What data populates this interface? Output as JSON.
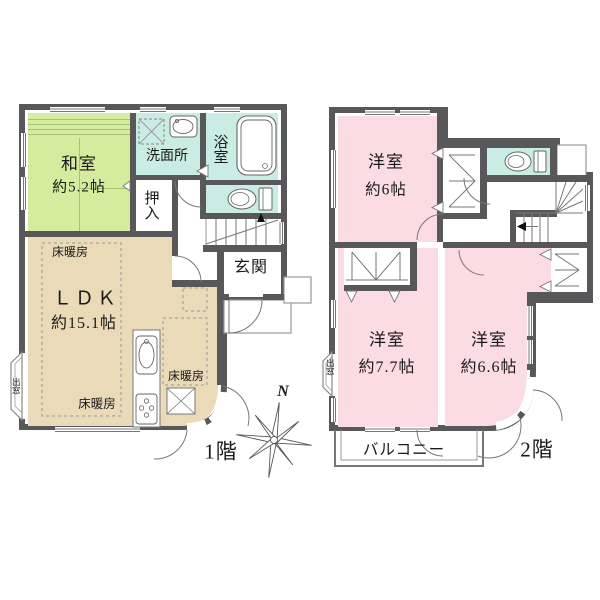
{
  "title": "2階建て間取り図",
  "floor1": {
    "floor_label": "1階",
    "washitsu_name": "和室",
    "washitsu_size": "約5.2帖",
    "senmenjo": "洗面所",
    "yokushitsu": "浴室",
    "oshiire": "押入",
    "genkan": "玄関",
    "ldk_name": "ＬＤＫ",
    "ldk_size": "約15.1帖",
    "yukadanbo": "床暖房",
    "demado": "出窓"
  },
  "floor2": {
    "floor_label": "2階",
    "room6_name": "洋室",
    "room6_size": "約6帖",
    "room77_name": "洋室",
    "room77_size": "約7.7帖",
    "room66_name": "洋室",
    "room66_size": "約6.6帖",
    "balcony": "バルコニー",
    "demado": "出窓"
  },
  "compass": {
    "north": "N"
  },
  "colors": {
    "wall": "#58585A",
    "tatami_room": "#D5EC9F",
    "wet_area": "#C9EDE2",
    "ldk": "#EADAB8",
    "western_room": "#FBDBE4"
  }
}
